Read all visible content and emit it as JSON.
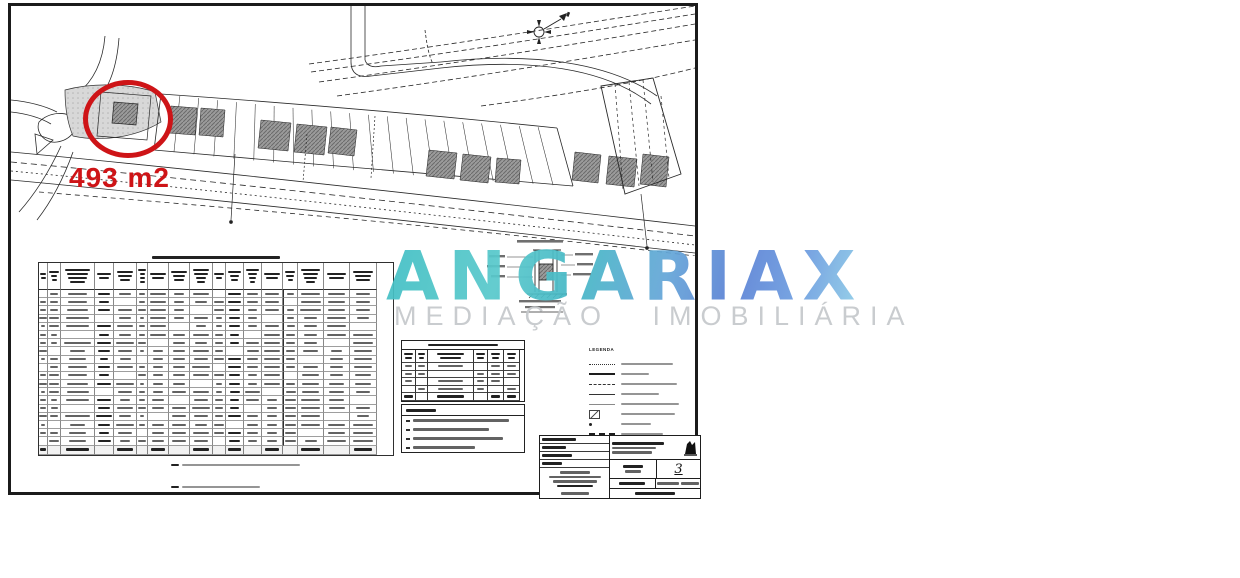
{
  "annotation": {
    "area_label": "493 m2"
  },
  "watermark": {
    "brand": "ANGARIAX",
    "tagline": "MEDIAÇÃO IMOBILIÁRIA"
  },
  "colors": {
    "highlight_red": "#ce1417",
    "brand_teal": "#43bfc4",
    "brand_blue": "#5b82d6",
    "tagline_gray": "#c7cacd"
  },
  "legend": {
    "title": "LEGENDA",
    "entry_count": 8
  },
  "title_block": {
    "sheet_number": "3"
  },
  "structure": {
    "main_table": {
      "column_widths": [
        9,
        13,
        34,
        19,
        23,
        11,
        21,
        21,
        23,
        13,
        18,
        18,
        21,
        15,
        26,
        26,
        27
      ],
      "data_rows": 19,
      "has_totals_row": true,
      "footnote_count": 2
    },
    "quadro_table": {
      "column_widths": [
        14,
        12,
        46,
        14,
        16,
        16
      ],
      "data_rows": 4
    },
    "notes": {
      "line_count": 4
    }
  }
}
